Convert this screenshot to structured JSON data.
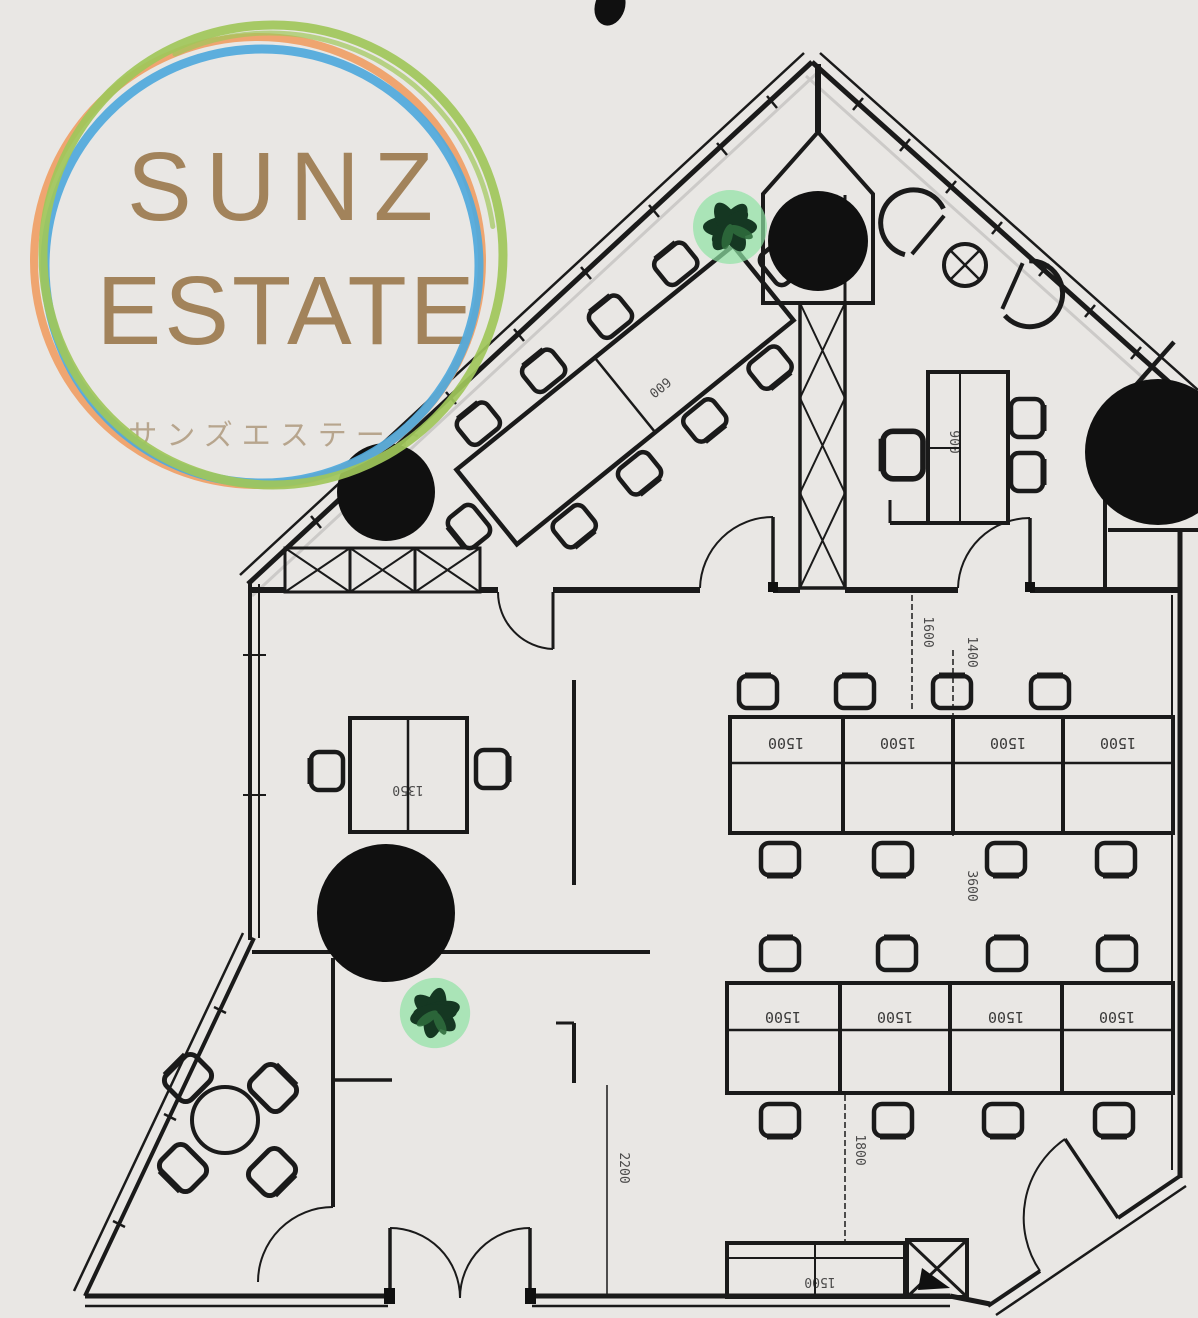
{
  "logo": {
    "line1": "SUNZ",
    "line2": "ESTATE",
    "subtitle": "サンズエステート",
    "text_color": "#a2835b",
    "subtitle_color": "#b5a289",
    "rings": {
      "green": "#9fc75a",
      "blue": "#4fa9dc",
      "orange": "#ef9f66"
    }
  },
  "plan": {
    "ink_color": "#1a1a1a",
    "background_color": "#e9e7e4",
    "plant_leaf_color": "#153722",
    "plant_glow_color": "#8fe3a4",
    "labels": {
      "desk_width": "1500",
      "desk_pair": "1350",
      "conference_width": "600",
      "desk_depth": "900",
      "dim_1400": "1400",
      "dim_1600": "1600",
      "dim_3600": "3600",
      "dim_1800": "1800",
      "dim_2200": "2200",
      "cabinet_width": "1500"
    }
  }
}
